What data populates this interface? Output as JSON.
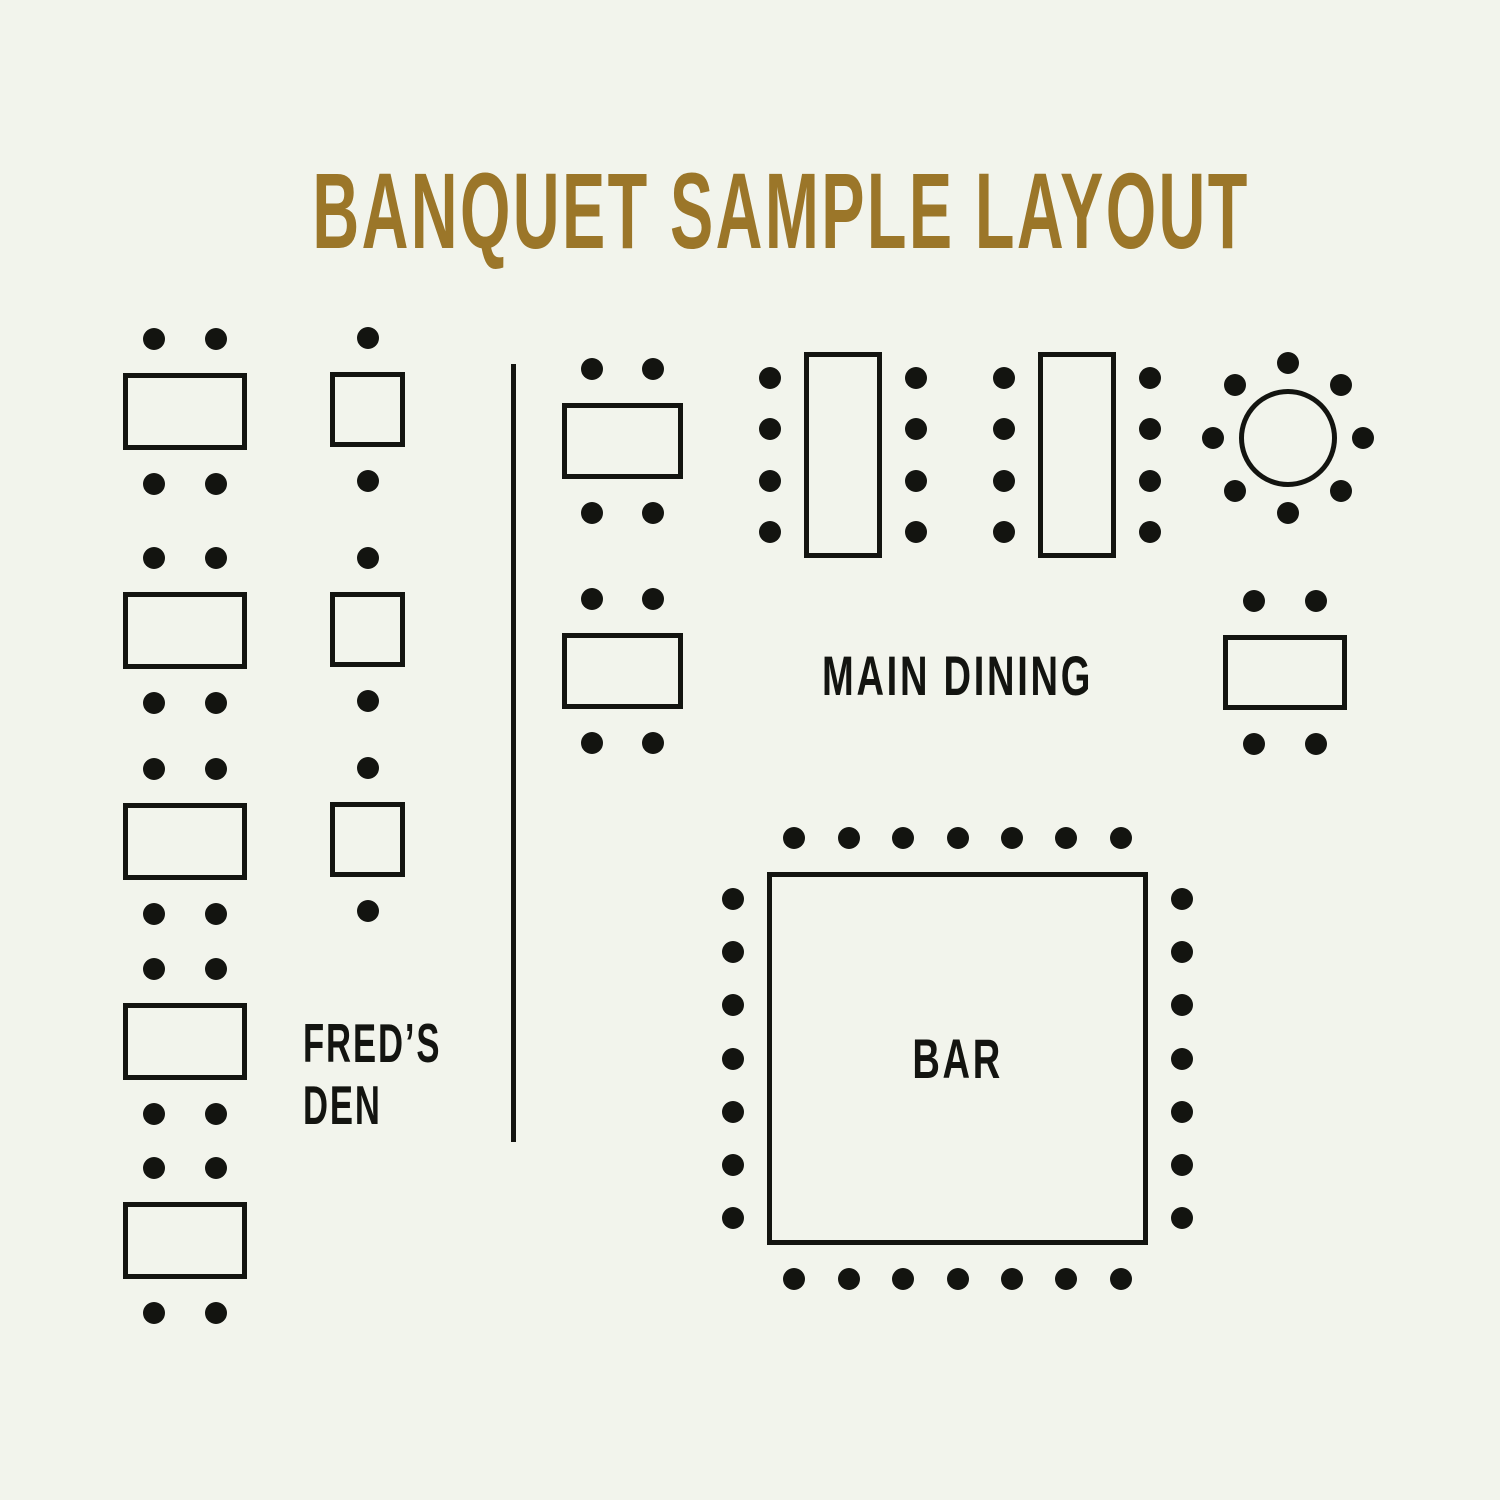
{
  "title": {
    "text": "BANQUET SAMPLE LAYOUT"
  },
  "colors": {
    "background": "#f2f4ec",
    "ink": "#131410",
    "gold": "#9b7629"
  },
  "labels": {
    "freds_den_line1": "FRED’S",
    "freds_den_line2": "DEN",
    "main_dining": "MAIN DINING",
    "bar": "BAR"
  },
  "chair": {
    "radius": 11,
    "gap": 34
  },
  "divider": {
    "x": 511,
    "top": 364,
    "height": 778
  },
  "tables": [
    {
      "id": "freds-den-1",
      "area": "freds-den",
      "shape": "rect",
      "x": 123,
      "y": 373,
      "w": 124,
      "h": 77,
      "seats": {
        "top": 2,
        "bottom": 2
      }
    },
    {
      "id": "freds-den-2",
      "area": "freds-den",
      "shape": "rect",
      "x": 123,
      "y": 592,
      "w": 124,
      "h": 77,
      "seats": {
        "top": 2,
        "bottom": 2
      }
    },
    {
      "id": "freds-den-3",
      "area": "freds-den",
      "shape": "rect",
      "x": 123,
      "y": 803,
      "w": 124,
      "h": 77,
      "seats": {
        "top": 2,
        "bottom": 2
      }
    },
    {
      "id": "freds-den-4",
      "area": "freds-den",
      "shape": "rect",
      "x": 123,
      "y": 1003,
      "w": 124,
      "h": 77,
      "seats": {
        "top": 2,
        "bottom": 2
      }
    },
    {
      "id": "freds-den-5",
      "area": "freds-den",
      "shape": "rect",
      "x": 123,
      "y": 1202,
      "w": 124,
      "h": 77,
      "seats": {
        "top": 2,
        "bottom": 2
      }
    },
    {
      "id": "freds-den-sq-1",
      "area": "freds-den",
      "shape": "rect",
      "x": 330,
      "y": 372,
      "w": 75,
      "h": 75,
      "seats": {
        "top": 1,
        "bottom": 1
      }
    },
    {
      "id": "freds-den-sq-2",
      "area": "freds-den",
      "shape": "rect",
      "x": 330,
      "y": 592,
      "w": 75,
      "h": 75,
      "seats": {
        "top": 1,
        "bottom": 1
      }
    },
    {
      "id": "freds-den-sq-3",
      "area": "freds-den",
      "shape": "rect",
      "x": 330,
      "y": 802,
      "w": 75,
      "h": 75,
      "seats": {
        "top": 1,
        "bottom": 1
      }
    },
    {
      "id": "main-dining-1",
      "area": "main-dining",
      "shape": "rect",
      "x": 562,
      "y": 403,
      "w": 121,
      "h": 76,
      "seats": {
        "top": 2,
        "bottom": 2
      }
    },
    {
      "id": "main-dining-2",
      "area": "main-dining",
      "shape": "rect",
      "x": 562,
      "y": 633,
      "w": 121,
      "h": 76,
      "seats": {
        "top": 2,
        "bottom": 2
      }
    },
    {
      "id": "main-dining-long-1",
      "area": "main-dining",
      "shape": "rect",
      "x": 804,
      "y": 352,
      "w": 78,
      "h": 206,
      "seats": {
        "left": 4,
        "right": 4
      }
    },
    {
      "id": "main-dining-long-2",
      "area": "main-dining",
      "shape": "rect",
      "x": 1038,
      "y": 352,
      "w": 78,
      "h": 206,
      "seats": {
        "left": 4,
        "right": 4
      }
    },
    {
      "id": "main-dining-round",
      "area": "main-dining",
      "shape": "circle",
      "cx": 1288,
      "cy": 438,
      "r": 49,
      "orbit": 75,
      "seats": {
        "around": 8
      }
    },
    {
      "id": "main-dining-3",
      "area": "main-dining",
      "shape": "rect",
      "x": 1223,
      "y": 635,
      "w": 124,
      "h": 75,
      "seats": {
        "top": 2,
        "bottom": 2
      }
    },
    {
      "id": "bar-counter",
      "area": "bar",
      "shape": "rect",
      "x": 767,
      "y": 872,
      "w": 381,
      "h": 373,
      "seats": {
        "top": 7,
        "bottom": 7,
        "left": 7,
        "right": 7
      }
    }
  ]
}
